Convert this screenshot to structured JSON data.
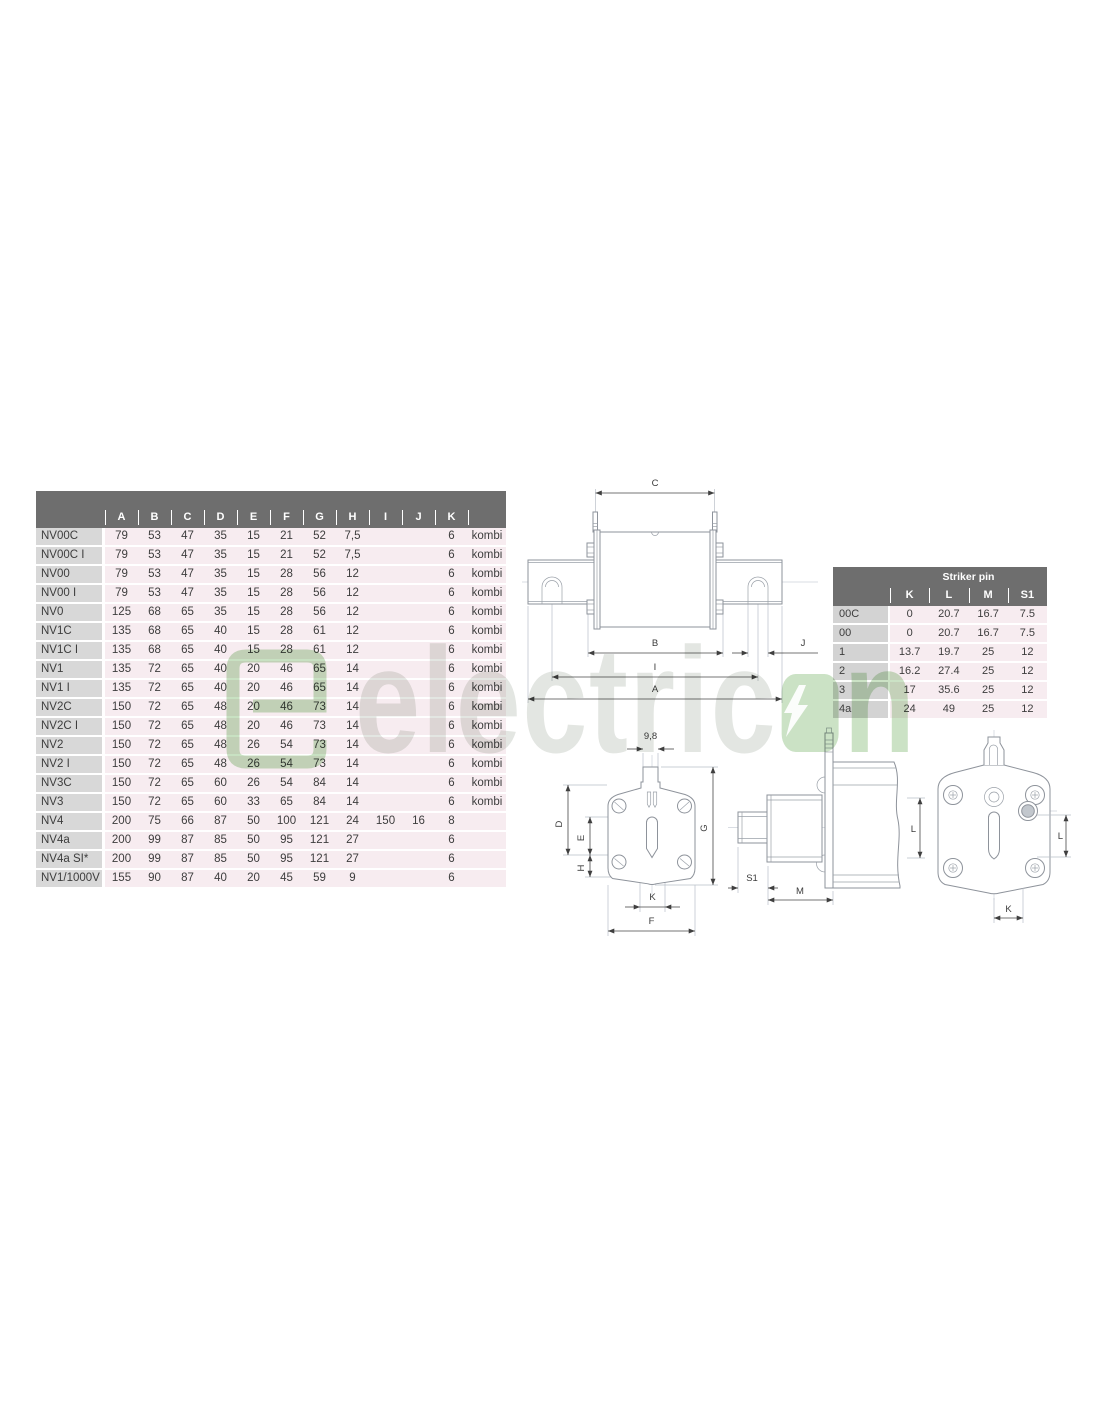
{
  "main_table": {
    "columns": [
      "A",
      "B",
      "C",
      "D",
      "E",
      "F",
      "G",
      "H",
      "I",
      "J",
      "K",
      ""
    ],
    "rows": [
      {
        "label": "NV00C",
        "values": [
          "79",
          "53",
          "47",
          "35",
          "15",
          "21",
          "52",
          "7,5",
          "",
          "",
          "6",
          "kombi"
        ]
      },
      {
        "label": "NV00C I",
        "values": [
          "79",
          "53",
          "47",
          "35",
          "15",
          "21",
          "52",
          "7,5",
          "",
          "",
          "6",
          "kombi"
        ]
      },
      {
        "label": "NV00",
        "values": [
          "79",
          "53",
          "47",
          "35",
          "15",
          "28",
          "56",
          "12",
          "",
          "",
          "6",
          "kombi"
        ]
      },
      {
        "label": "NV00 I",
        "values": [
          "79",
          "53",
          "47",
          "35",
          "15",
          "28",
          "56",
          "12",
          "",
          "",
          "6",
          "kombi"
        ]
      },
      {
        "label": "NV0",
        "values": [
          "125",
          "68",
          "65",
          "35",
          "15",
          "28",
          "56",
          "12",
          "",
          "",
          "6",
          "kombi"
        ]
      },
      {
        "label": "NV1C",
        "values": [
          "135",
          "68",
          "65",
          "40",
          "15",
          "28",
          "61",
          "12",
          "",
          "",
          "6",
          "kombi"
        ]
      },
      {
        "label": "NV1C I",
        "values": [
          "135",
          "68",
          "65",
          "40",
          "15",
          "28",
          "61",
          "12",
          "",
          "",
          "6",
          "kombi"
        ]
      },
      {
        "label": "NV1",
        "values": [
          "135",
          "72",
          "65",
          "40",
          "20",
          "46",
          "65",
          "14",
          "",
          "",
          "6",
          "kombi"
        ]
      },
      {
        "label": "NV1 I",
        "values": [
          "135",
          "72",
          "65",
          "40",
          "20",
          "46",
          "65",
          "14",
          "",
          "",
          "6",
          "kombi"
        ]
      },
      {
        "label": "NV2C",
        "values": [
          "150",
          "72",
          "65",
          "48",
          "20",
          "46",
          "73",
          "14",
          "",
          "",
          "6",
          "kombi"
        ]
      },
      {
        "label": "NV2C I",
        "values": [
          "150",
          "72",
          "65",
          "48",
          "20",
          "46",
          "73",
          "14",
          "",
          "",
          "6",
          "kombi"
        ]
      },
      {
        "label": "NV2",
        "values": [
          "150",
          "72",
          "65",
          "48",
          "26",
          "54",
          "73",
          "14",
          "",
          "",
          "6",
          "kombi"
        ]
      },
      {
        "label": "NV2 I",
        "values": [
          "150",
          "72",
          "65",
          "48",
          "26",
          "54",
          "73",
          "14",
          "",
          "",
          "6",
          "kombi"
        ]
      },
      {
        "label": "NV3C",
        "values": [
          "150",
          "72",
          "65",
          "60",
          "26",
          "54",
          "84",
          "14",
          "",
          "",
          "6",
          "kombi"
        ]
      },
      {
        "label": "NV3",
        "values": [
          "150",
          "72",
          "65",
          "60",
          "33",
          "65",
          "84",
          "14",
          "",
          "",
          "6",
          "kombi"
        ]
      },
      {
        "label": "NV4",
        "values": [
          "200",
          "75",
          "66",
          "87",
          "50",
          "100",
          "121",
          "24",
          "150",
          "16",
          "8",
          ""
        ]
      },
      {
        "label": "NV4a",
        "values": [
          "200",
          "99",
          "87",
          "85",
          "50",
          "95",
          "121",
          "27",
          "",
          "",
          "6",
          ""
        ]
      },
      {
        "label": "NV4a SI*",
        "values": [
          "200",
          "99",
          "87",
          "85",
          "50",
          "95",
          "121",
          "27",
          "",
          "",
          "6",
          ""
        ]
      },
      {
        "label": "NV1/1000V",
        "values": [
          "155",
          "90",
          "87",
          "40",
          "20",
          "45",
          "59",
          "9",
          "",
          "",
          "6",
          ""
        ]
      }
    ]
  },
  "striker_table": {
    "title": "Striker pin",
    "columns": [
      "K",
      "L",
      "M",
      "S1"
    ],
    "rows": [
      {
        "label": "00C",
        "values": [
          "0",
          "20.7",
          "16.7",
          "7.5"
        ]
      },
      {
        "label": "00",
        "values": [
          "0",
          "20.7",
          "16.7",
          "7.5"
        ]
      },
      {
        "label": "1",
        "values": [
          "13.7",
          "19.7",
          "25",
          "12"
        ]
      },
      {
        "label": "2",
        "values": [
          "16.2",
          "27.4",
          "25",
          "12"
        ]
      },
      {
        "label": "3",
        "values": [
          "17",
          "35.6",
          "25",
          "12"
        ]
      },
      {
        "label": "4a",
        "values": [
          "24",
          "49",
          "25",
          "12"
        ]
      }
    ]
  },
  "drawings": {
    "front": {
      "c": "C",
      "b": "B",
      "j": "J",
      "i": "I",
      "a": "A"
    },
    "end_view": {
      "width": "9,8",
      "d": "D",
      "e": "E",
      "h": "H",
      "g": "G",
      "k": "K",
      "f": "F"
    },
    "side_view": {
      "s1": "S1",
      "m": "M",
      "l": "L"
    },
    "rear_view": {
      "l": "L",
      "k": "K"
    }
  },
  "watermark": {
    "text_gray": "electric",
    "text_green_n": "n"
  },
  "colors": {
    "header_gray": "#6e6e6e",
    "row_label_gray": "#d8d8d8",
    "cell_pink": "#f7ecf0",
    "watermark_green": "#cbe2c5",
    "watermark_gray": "#e3e6e2",
    "line_gray": "#8e939b"
  }
}
